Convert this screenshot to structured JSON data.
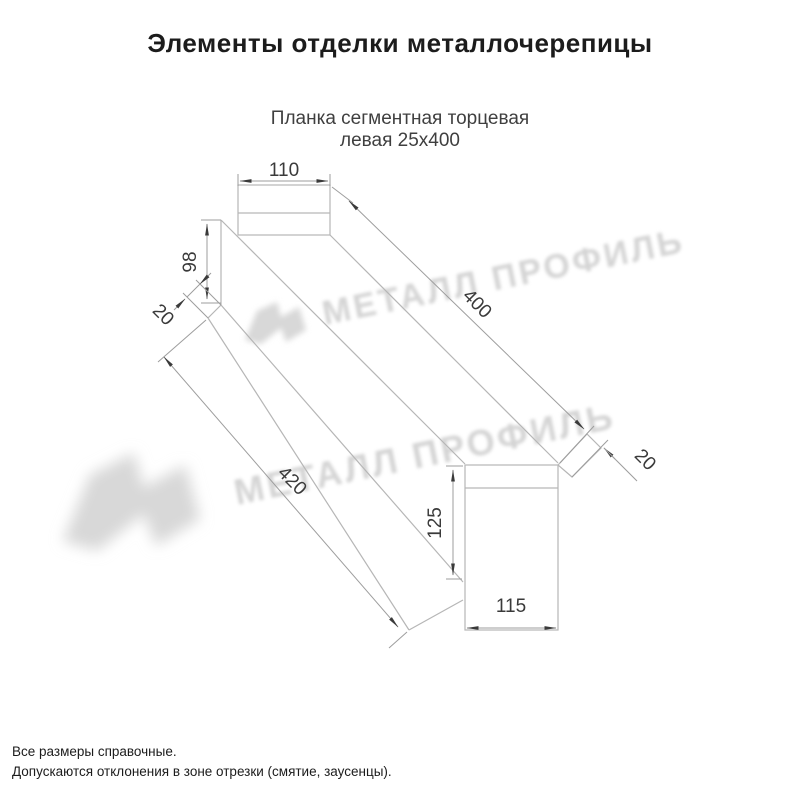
{
  "title": "Элементы отделки металлочерепицы",
  "subtitle": {
    "line1": "Планка сегментная торцевая",
    "line2": "левая 25х400"
  },
  "watermark": {
    "brand": "МЕТАЛЛ ПРОФИЛЬ"
  },
  "dimensions": {
    "flange_width": "110",
    "end_height_near": "98",
    "hem_near": "20",
    "length_flange": "400",
    "length_web": "420",
    "hem_far": "20",
    "end_height_far": "125",
    "end_width_far": "115"
  },
  "footer": {
    "line1": "Все размеры справочные.",
    "line2": "Допускаются отклонения в зоне отрезки (смятие, заусенцы)."
  },
  "colors": {
    "background": "#ffffff",
    "part_line": "#b6b6b6",
    "dimension_line": "#9d9d9d",
    "arrow": "#3a3a3a",
    "dimension_text": "#3a3a3a",
    "title_text": "#1c1c1c",
    "subtitle_text": "#3f3f3f",
    "footer_text": "#1c1c1c",
    "watermark": "#d4d4d4"
  }
}
